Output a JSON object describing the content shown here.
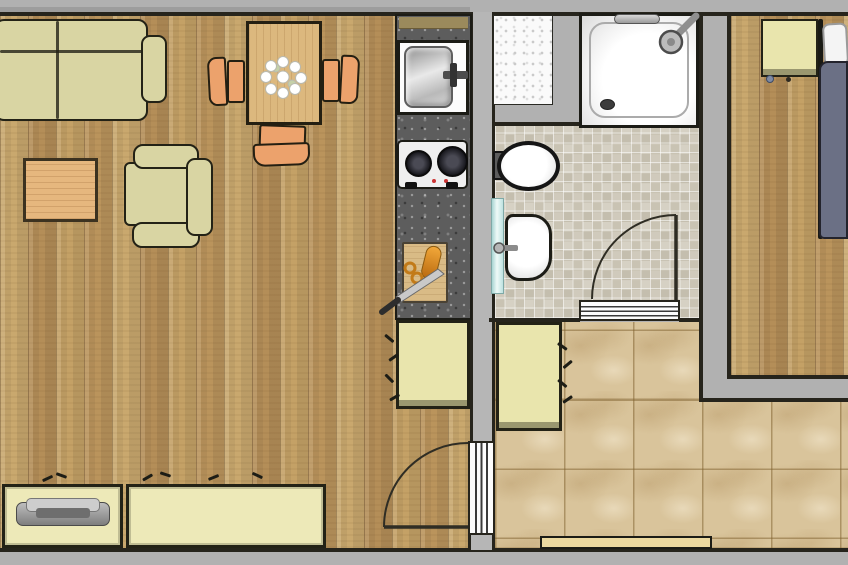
{
  "title": "Studio apartment floor plan (top-down view)",
  "canvas": {
    "width": 848,
    "height": 565
  },
  "colors": {
    "bg": "#b1b1b1",
    "wall-line": "#26241c",
    "wall-fill": "#b6b6b6",
    "outline": "#232216",
    "wood-a": "#c9a86e",
    "wood-b": "#b48e58",
    "wood-c": "#c4a166",
    "wood-d": "#ba945c",
    "cream": "#d9d5a3",
    "cabinet": "#e9e5ad",
    "sideboard": "#ede9b8",
    "chair": "#eca26c",
    "table-wood": "#dcb87e",
    "coffee-wood": "#e6b77e",
    "board": "#d9bb86",
    "counter": "#5d5d5d",
    "shelf": "#9b8a5c",
    "tile-a": "#d6d1c4",
    "tile-b": "#c4beae",
    "hall-tile": "#d9c49b",
    "white": "#fcfcfc",
    "duvet": "#6b7085",
    "radiator": "#cfeeea",
    "mat": "#ecd9a0",
    "niche": "#fafafa",
    "carrot": "#e08a20",
    "burner": "#1b1b20",
    "red-dot": "#cc3333",
    "arc": "#2f2d24"
  },
  "rooms": [
    {
      "id": "living-room",
      "label": "Living room",
      "floor": "wood planks",
      "furniture": [
        "sofa",
        "coffee-table",
        "armchair",
        "dining-table",
        "dining-chair x3",
        "sideboard x2",
        "tv-unit"
      ]
    },
    {
      "id": "kitchenette",
      "label": "Kitchenette",
      "floor": "dark stone counter strip",
      "furniture": [
        "sink",
        "two-burner-stove",
        "cutting-board with carrot and knife",
        "base-cabinet"
      ]
    },
    {
      "id": "bathroom",
      "label": "Bathroom",
      "floor": "small ceramic tiles",
      "furniture": [
        "shower",
        "toilet",
        "washbasin",
        "radiator",
        "washing-machine-niche"
      ]
    },
    {
      "id": "hallway",
      "label": "Hallway",
      "floor": "large stone tiles",
      "furniture": [
        "cabinet",
        "doormat"
      ]
    },
    {
      "id": "bedroom",
      "label": "Bedroom",
      "floor": "wood planks",
      "furniture": [
        "bed with pillow and duvet",
        "nightstand"
      ]
    }
  ],
  "doors": [
    {
      "id": "door-living-hall",
      "type": "swing",
      "between": [
        "living-room",
        "hallway"
      ]
    },
    {
      "id": "door-bathroom",
      "type": "swing",
      "between": [
        "bathroom",
        "hallway"
      ]
    }
  ]
}
